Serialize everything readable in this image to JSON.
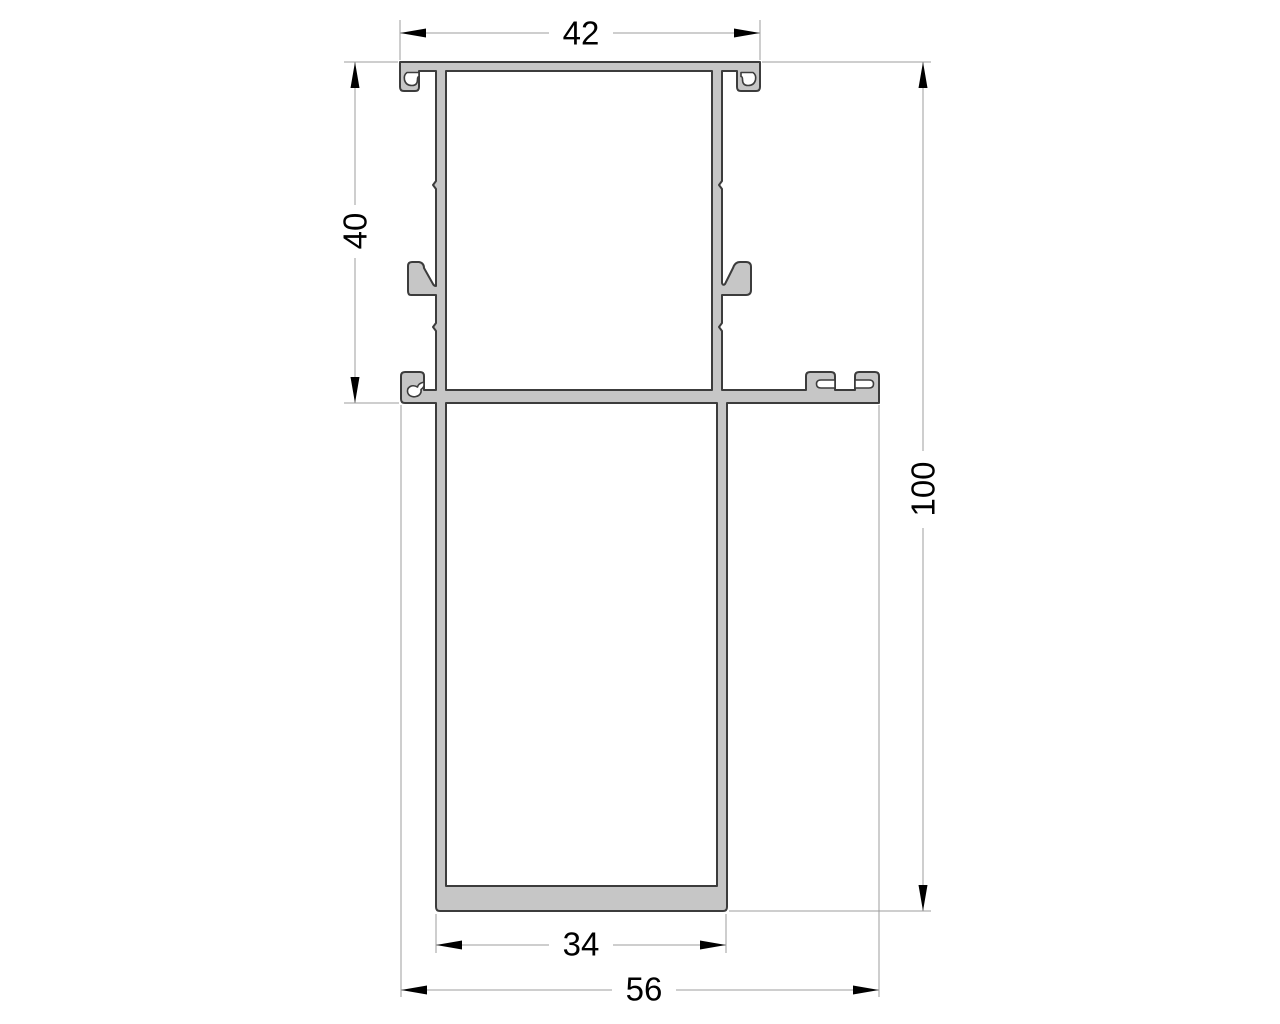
{
  "drawing": {
    "kind": "technical cross-section of an aluminium extrusion profile",
    "dimensions": [
      {
        "name": "top-width",
        "value": "42",
        "orientation": "horizontal",
        "location": "top"
      },
      {
        "name": "upper-section-height",
        "value": "40",
        "orientation": "vertical",
        "location": "left"
      },
      {
        "name": "overall-height",
        "value": "100",
        "orientation": "vertical",
        "location": "right"
      },
      {
        "name": "bottom-width",
        "value": "34",
        "orientation": "horizontal",
        "location": "bottom"
      },
      {
        "name": "overall-width",
        "value": "56",
        "orientation": "horizontal",
        "location": "bottom"
      }
    ],
    "colors": {
      "background": "#ffffff",
      "profile_fill": "#c6c6c6",
      "profile_outline": "#3c3c3c",
      "dimension_line": "#9c9c9c",
      "dimension_text": "#000000",
      "arrow": "#000000"
    }
  }
}
